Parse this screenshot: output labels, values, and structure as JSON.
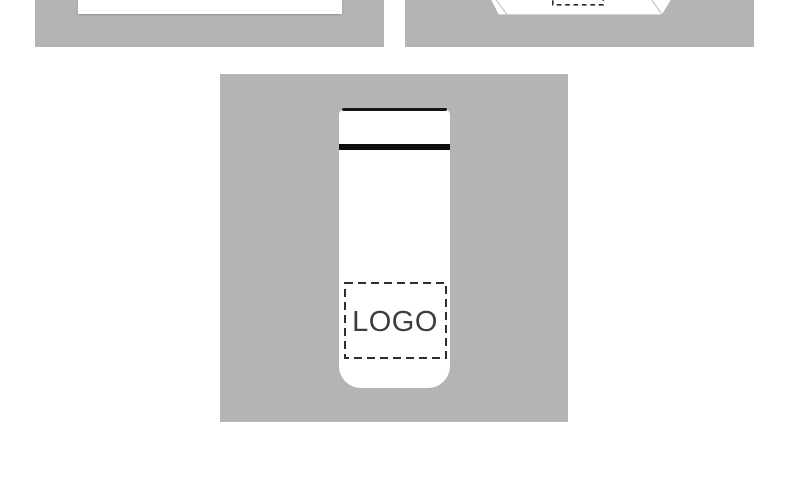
{
  "colors": {
    "tile_background": "#b4b4b4",
    "mockup_surface": "#ffffff",
    "bottle_lid_line": "#161616",
    "bottle_band": "#0d0d0d",
    "placeholder_dash": "#2f2f2f",
    "logo_text": "#3d3d3d",
    "box_crease": "#c6c6c6"
  },
  "gallery": {
    "tiles": [
      {
        "name": "card-mockup"
      },
      {
        "name": "box-mockup"
      },
      {
        "name": "bottle-mockup",
        "logo_label": "LOGO"
      }
    ]
  }
}
